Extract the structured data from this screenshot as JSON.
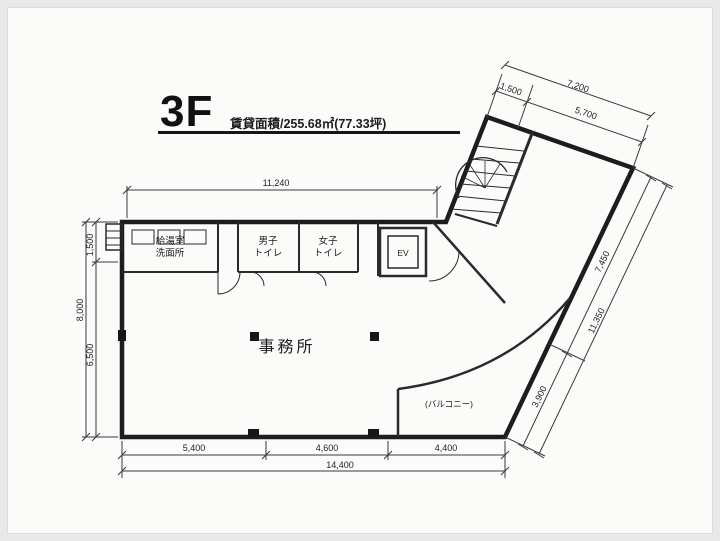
{
  "frame": {
    "background": "#e9e9e9",
    "canvas": "#fbfbfa",
    "ink": "#1d1d1d"
  },
  "header": {
    "floor_label": "3F",
    "area_label": "賃貸面積/255.68㎡(77.33坪)"
  },
  "rooms": {
    "office_label": "事務所",
    "balcony_label": "(バルコニー)",
    "elevator_label": "EV",
    "room_a_line1": "給湯室",
    "room_a_line2": "洗面所",
    "room_b_line1": "男子",
    "room_b_line2": "トイレ",
    "room_c_line1": "女子",
    "room_c_line2": "トイレ"
  },
  "dimensions": {
    "top_width": "11,240",
    "left_upper": "1,500",
    "left_lower": "6,500",
    "left_total": "8,000",
    "wing_short": "1,500",
    "wing_long": "5,700",
    "wing_total": "7,200",
    "right_upper": "7,450",
    "right_lower": "3,900",
    "right_total": "11,350",
    "bottom_seg1": "5,400",
    "bottom_seg2": "4,600",
    "bottom_seg3": "4,400",
    "bottom_total": "14,400"
  }
}
